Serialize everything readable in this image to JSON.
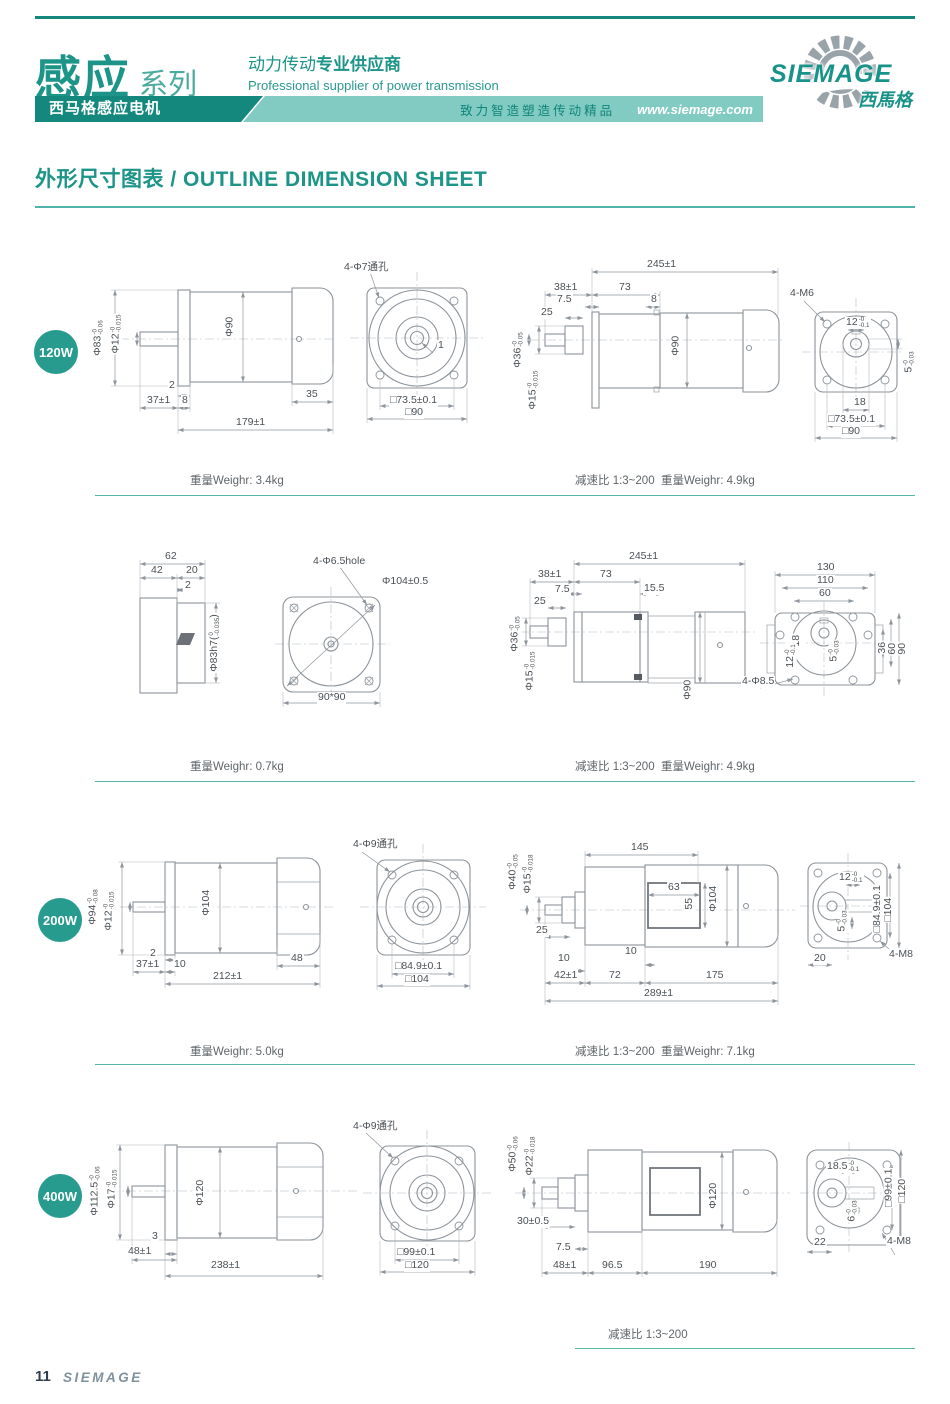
{
  "header": {
    "series_cn": "感应",
    "series_suffix": "系列",
    "slogan_cn": "动力传动",
    "slogan_cn_bold": "专业供应商",
    "slogan_en": "Professional supplier of power transmission",
    "product_bar": "西马格感应电机",
    "tagline": "致力智造塑造传动精品",
    "website": "www.siemage.com",
    "logo": "SIEMAGE",
    "logo_cn": "西馬格"
  },
  "title": "外形尺寸图表 / OUTLINE DIMENSION SHEET",
  "colors": {
    "brand_teal": "#1c9488",
    "bar_dark": "#14887c",
    "bar_light": "#82cbc3",
    "drawing_line": "#8d949b",
    "dim_text": "#4b5156"
  },
  "rows": [
    {
      "badge": "120W",
      "side": {
        "dia_body": {
          "t": "Φ83",
          "sup": "-0",
          "sub": "-0.06"
        },
        "dia_shaft": {
          "t": "Φ12",
          "sup": "-0",
          "sub": "-0.015"
        },
        "dia_motor": "Φ90",
        "flange_t": "2",
        "shaft_len": "37±1",
        "plate": "8",
        "rear": "35",
        "total": "179±1"
      },
      "front": {
        "holes": "4-Φ7通孔",
        "key": "1",
        "bolt_sq": "□73.5±0.1",
        "outer_sq": "□90"
      },
      "gside": {
        "total": "245±1",
        "shaft": "38±1",
        "gbox": "73",
        "dim_7_5": "7.5",
        "dim_8": "8",
        "dim_25": "25",
        "dia_spigot": {
          "t": "Φ36",
          "sup": "-0",
          "sub": "-0.05"
        },
        "dia_shaft": {
          "t": "Φ15",
          "sup": "-0",
          "sub": "-0.015"
        },
        "dia_motor": "Φ90"
      },
      "gfront": {
        "holes": "4-M6",
        "key_w": {
          "t": "12",
          "sup": "-0",
          "sub": "-0.1"
        },
        "key_h": {
          "t": "5",
          "sup": "-0",
          "sub": "-0.03"
        },
        "dim_18": "18",
        "bolt_sq": "□73.5±0.1",
        "outer_sq": "□90"
      },
      "caption_left": "重量Weighr: 3.4kg",
      "caption_right": "减速比 1:3~200  重量Weighr: 4.9kg"
    },
    {
      "badge": null,
      "side": {
        "dim_62": "62",
        "dim_42": "42",
        "dim_20": "20",
        "dim_2": "2",
        "dia": {
          "t": "Φ83h7(",
          "sup": "0",
          "sub": "-0.035",
          "post": ")"
        }
      },
      "front": {
        "holes": "4-Φ6.5hole",
        "dia": "Φ104±0.5",
        "sq": "90*90"
      },
      "gside": {
        "total": "245±1",
        "shaft": "38±1",
        "gbox": "73",
        "dim_7_5": "7.5",
        "dim_15_5": "15.5",
        "dim_25": "25",
        "dia_spigot": {
          "t": "Φ36",
          "sup": "-0",
          "sub": "-0.05"
        },
        "dia_shaft": {
          "t": "Φ15",
          "sup": "-0",
          "sub": "-0.015"
        },
        "dia_motor": "Φ90"
      },
      "gfront": {
        "dim_130": "130",
        "dim_110": "110",
        "dim_60": "60",
        "dim_18": "18",
        "key_w": {
          "t": "12",
          "sup": "-0",
          "sub": "-0.1"
        },
        "key_h": {
          "t": "5",
          "sup": "-0",
          "sub": "-0.03"
        },
        "dim_r36": "36",
        "dim_r60": "60",
        "dim_r90": "90",
        "holes": "4-Φ8.5"
      },
      "caption_left": "重量Weighr: 0.7kg",
      "caption_right": "减速比 1:3~200  重量Weighr: 4.9kg"
    },
    {
      "badge": "200W",
      "side": {
        "dia_body": {
          "t": "Φ94",
          "sup": "-0",
          "sub": "-0.08"
        },
        "dia_shaft": {
          "t": "Φ12",
          "sup": "-0",
          "sub": "-0.015"
        },
        "dia_motor": "Φ104",
        "flange_t": "2",
        "shaft_len": "37±1",
        "plate": "10",
        "rear": "48",
        "total": "212±1"
      },
      "front": {
        "holes": "4-Φ9通孔",
        "bolt_sq": "□84.9±0.1",
        "outer_sq": "□104"
      },
      "gside": {
        "dia_spigot": {
          "t": "Φ40",
          "sup": "-0",
          "sub": "-0.05"
        },
        "dia_shaft": {
          "t": "Φ15",
          "sup": "-0",
          "sub": "-0.018"
        },
        "dim_145": "145",
        "dim_63": "63",
        "dim_55": "55",
        "dia_motor": "Φ104",
        "dim_25": "25",
        "dim_10a": "10",
        "dim_42": "42±1",
        "dim_10b": "10",
        "dim_72": "72",
        "dim_175": "175",
        "total": "289±1"
      },
      "gfront": {
        "key_w": {
          "t": "12",
          "sup": "-0",
          "sub": "-0.1"
        },
        "key_h": {
          "t": "5",
          "sup": "-0",
          "sub": "-0.03"
        },
        "bolt_sq": "□84.9±0.1",
        "outer_sq": "□104",
        "dim_20": "20",
        "holes": "4-M8"
      },
      "caption_left": "重量Weighr: 5.0kg",
      "caption_right": "减速比 1:3~200  重量Weighr: 7.1kg"
    },
    {
      "badge": "400W",
      "side": {
        "dia_body": {
          "t": "Φ112.5",
          "sup": "-0",
          "sub": "-0.06"
        },
        "dia_shaft": {
          "t": "Φ17",
          "sup": "-0",
          "sub": "-0.015"
        },
        "dia_motor": "Φ120",
        "dim_3": "3",
        "dim_48": "48±1",
        "total": "238±1"
      },
      "front": {
        "holes": "4-Φ9通孔",
        "bolt_sq": "□99±0.1",
        "outer_sq": "□120"
      },
      "gside": {
        "dia_spigot": {
          "t": "Φ50",
          "sup": "-0",
          "sub": "-0.06"
        },
        "dia_shaft": {
          "t": "Φ22",
          "sup": "-0",
          "sub": "-0.018"
        },
        "dim_30": "30±0.5",
        "dim_7_5": "7.5",
        "dim_48": "48±1",
        "dim_96_5": "96.5",
        "dim_190": "190",
        "dia_motor": "Φ120"
      },
      "gfront": {
        "key_w": {
          "t": "18.5",
          "sup": "-0",
          "sub": "-0.1"
        },
        "key_h": {
          "t": "6",
          "sup": "-0",
          "sub": "-0.03"
        },
        "bolt_sq": "□99±0.1",
        "outer_sq": "□120",
        "dim_22": "22",
        "holes": "4-M8"
      },
      "caption_right": "减速比 1:3~200"
    }
  ],
  "footer": {
    "page": "11",
    "brand": "SIEMAGE"
  }
}
